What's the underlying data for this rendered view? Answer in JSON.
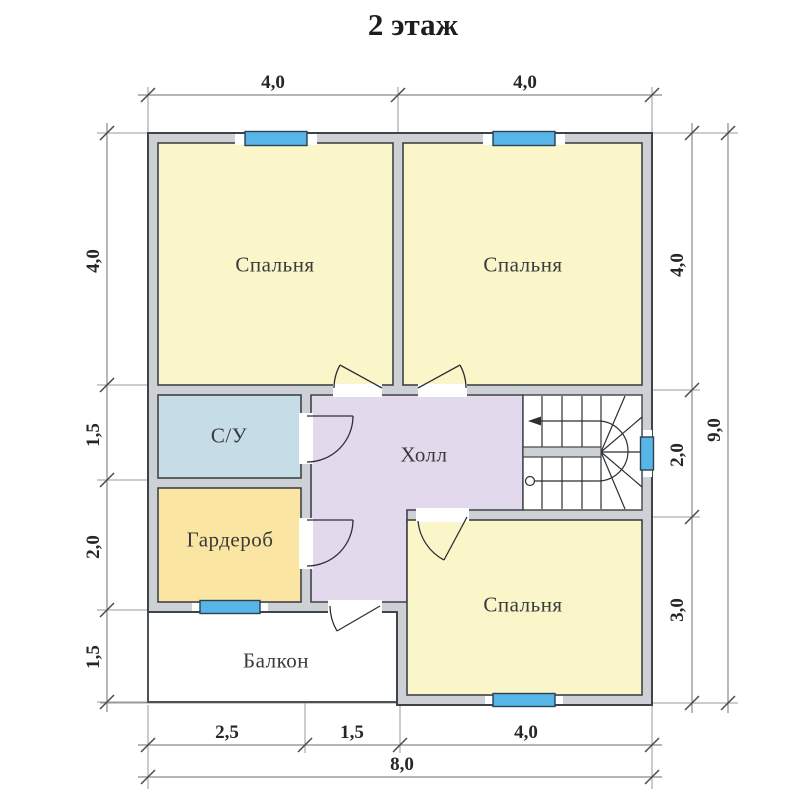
{
  "title": "2 этаж",
  "rooms": {
    "bedroom1": "Спальня",
    "bedroom2": "Спальня",
    "bedroom3": "Спальня",
    "bathroom": "С/У",
    "wardrobe": "Гардероб",
    "hall": "Холл",
    "balcony": "Балкон"
  },
  "dimensions": {
    "top": [
      "4,0",
      "4,0"
    ],
    "left": [
      "4,0",
      "1,5",
      "2,0",
      "1,5"
    ],
    "right": [
      "4,0",
      "2,0",
      "3,0"
    ],
    "right_total": "9,0",
    "bottom": [
      "2,5",
      "1,5",
      "4,0"
    ],
    "bottom_total": "8,0"
  },
  "colors": {
    "bedroom": "#faf6ca",
    "bathroom": "#c6dde8",
    "wardrobe": "#fbe5a3",
    "hall": "#e3d9ec",
    "wall": "#cdd1d5",
    "window": "#57b6e8",
    "stairs": "#ffffff",
    "balcony": "#ffffff"
  }
}
